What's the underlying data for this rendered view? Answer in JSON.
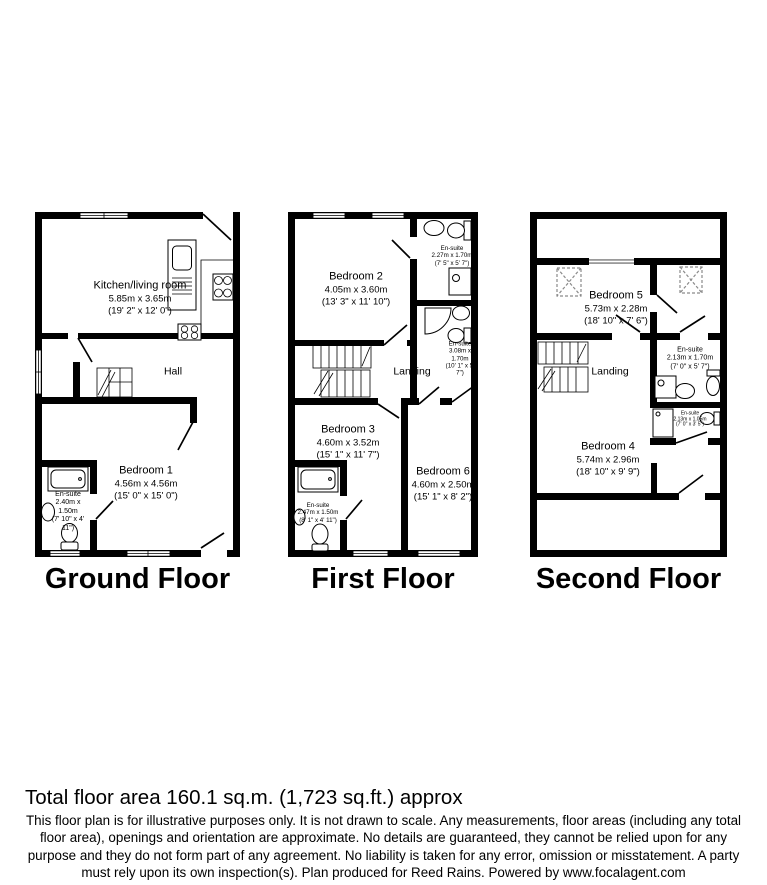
{
  "footer": {
    "total_area": "Total floor area 160.1 sq.m. (1,723 sq.ft.) approx",
    "disclaimer": "This floor plan is for illustrative purposes only. It is not drawn to scale. Any measurements, floor areas (including any total floor area), openings and orientation are approximate. No details are guaranteed, they cannot be relied upon for any purpose and they do not form part of any agreement. No liability is taken for any error, omission or misstatement. A party must rely upon its own inspection(s). Plan produced for Reed Rains. Powered by www.focalagent.com"
  },
  "floors": [
    {
      "title": "Ground Floor",
      "rooms": {
        "kitchen": {
          "name": "Kitchen/living room",
          "metric": "5.85m x 3.65m",
          "imperial": "(19' 2\" x 12' 0\")"
        },
        "hall": {
          "name": "Hall"
        },
        "bedroom1": {
          "name": "Bedroom 1",
          "metric": "4.56m x 4.56m",
          "imperial": "(15' 0\" x 15' 0\")"
        },
        "ensuite": {
          "name": "En-suite",
          "metric": "2.40m x 1.50m",
          "imperial": "(7' 10\" x 4' 11\")"
        }
      }
    },
    {
      "title": "First Floor",
      "rooms": {
        "bedroom2": {
          "name": "Bedroom 2",
          "metric": "4.05m x 3.60m",
          "imperial": "(13' 3\" x 11' 10\")"
        },
        "ensuite_top": {
          "name": "En-suite",
          "metric": "2.27m x 1.70m",
          "imperial": "(7' 5\" x 5' 7\")"
        },
        "ensuite_mid": {
          "name": "En-suite",
          "metric": "3.08m x 1.70m",
          "imperial": "(10' 1\" x 5' 7\")"
        },
        "landing": {
          "name": "Landing"
        },
        "bedroom3": {
          "name": "Bedroom 3",
          "metric": "4.60m x 3.52m",
          "imperial": "(15' 1\" x 11' 7\")"
        },
        "bedroom6": {
          "name": "Bedroom 6",
          "metric": "4.60m x 2.50m",
          "imperial": "(15' 1\" x 8' 2\")"
        },
        "ensuite_bottom": {
          "name": "En-suite",
          "metric": "2.47m x 1.50m",
          "imperial": "(8' 1\" x 4' 11\")"
        }
      }
    },
    {
      "title": "Second Floor",
      "rooms": {
        "bedroom5": {
          "name": "Bedroom 5",
          "metric": "5.73m x 2.28m",
          "imperial": "(18' 10\" x 7' 6\")"
        },
        "landing": {
          "name": "Landing"
        },
        "ensuite": {
          "name": "En-suite",
          "metric": "2.13m x 1.70m",
          "imperial": "(7' 0\" x 5' 7\")"
        },
        "ensuite_small": {
          "name": "En-suite",
          "metric": "2.13m x 1.05m",
          "imperial": "(7' 0\" x 3' 5\")"
        },
        "bedroom4": {
          "name": "Bedroom 4",
          "metric": "5.74m x 2.96m",
          "imperial": "(18' 10\" x 9' 9\")"
        }
      }
    }
  ]
}
